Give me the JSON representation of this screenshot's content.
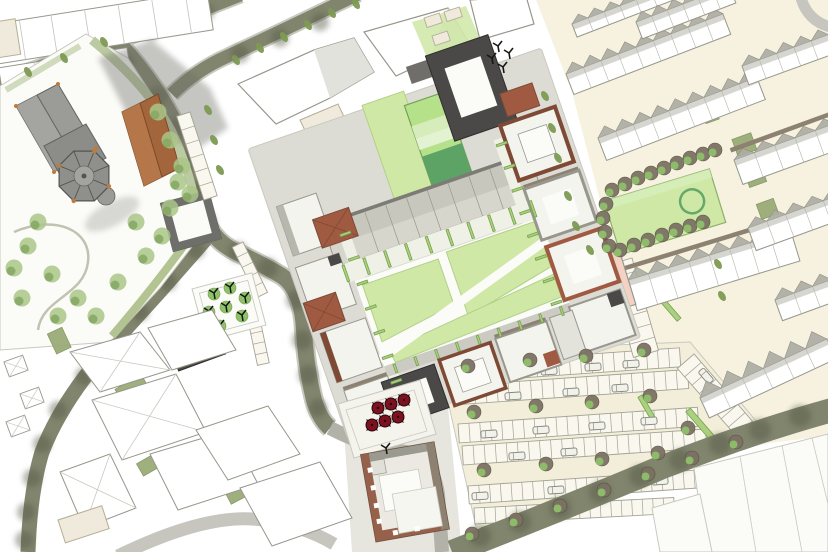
{
  "colors": {
    "bg": "#ffffff",
    "cream": "#f6f2df",
    "cream2": "#f3eeda",
    "cream_bldg": "#efeadb",
    "tan_stroke": "#b5ad96",
    "road_olive": "#82856e",
    "road_mid": "#b2b2a9",
    "road_gray": "#b7b7ae",
    "road_light": "#c6c6bf",
    "curb": "#c9c9c0",
    "road_shade": "#545743",
    "sidewalk": "#dcdcd4",
    "bldg_white": "#ffffff",
    "bldg_fill": "#f4f4ef",
    "white_soft": "#fbfbf8",
    "facet": "#e2e2dc",
    "bldg_stroke": "#97978d",
    "gray_soft": "#e6e6de",
    "gray_soft2": "#e3e3db",
    "roof_row": "#c7c7be",
    "roof_row_light": "#d8d8d0",
    "roof_gray": "#adada3",
    "roof_dark": "#7c7c74",
    "taupe": "#8d8172",
    "charcoal": "#4a4947",
    "charcoal_mid": "#6f6e6a",
    "charcoal_dark": "#2f2e2d",
    "terracotta": "#a05a42",
    "terracotta_dark": "#7e4a36",
    "copper": "#c07a3a",
    "church_gray": "#9b9b97",
    "church_gray2": "#8c8c88",
    "church_stroke": "#64645f",
    "roofring": "#6e6e6a",
    "brown_roof": "#a2653c",
    "brown_roof_light": "#b5764a",
    "shadow": "#6e6e68",
    "lawn": "#cfe8a6",
    "lawn_stroke": "#b2d188",
    "lawn_stroke2": "#8fae6b",
    "lawn_bright": "#b6e18b",
    "lawn_band": "#d6edbb",
    "lawn_band2": "#e3f2d0",
    "green_dark": "#5ea366",
    "green_ring": "#66a86a",
    "hedge_fill": "#abd07f",
    "hedge_stroke": "#75a24c",
    "garden_base": "#f0f1e6",
    "garden_olive": "#95a871",
    "tree_olive": "#7d9a52",
    "tree_soft": "#a9c687",
    "tree_soft_dark": "#86a861",
    "tree_brown": "#7b7164",
    "tree_green": "#8fc06a",
    "pink": "#f3d2c3",
    "umbrella_red": "#7c1120",
    "stall_fill": "#faf8ee",
    "stall_stroke": "#a3a396",
    "car_fill": "#f2f2ec"
  },
  "scene": {
    "street_trees": [
      [
        236,
        60
      ],
      [
        260,
        48
      ],
      [
        284,
        37
      ],
      [
        308,
        25
      ],
      [
        332,
        13
      ],
      [
        356,
        4
      ],
      [
        545,
        96
      ],
      [
        552,
        128
      ],
      [
        558,
        158
      ],
      [
        568,
        196
      ],
      [
        576,
        226
      ],
      [
        590,
        250
      ],
      [
        718,
        264
      ],
      [
        722,
        296
      ],
      [
        64,
        58
      ],
      [
        104,
        42
      ],
      [
        28,
        72
      ],
      [
        208,
        110
      ],
      [
        214,
        140
      ],
      [
        220,
        170
      ]
    ],
    "churchyard_trees": [
      [
        28,
        246
      ],
      [
        52,
        274
      ],
      [
        22,
        298
      ],
      [
        78,
        298
      ],
      [
        118,
        282
      ],
      [
        146,
        256
      ],
      [
        38,
        222
      ],
      [
        136,
        222
      ],
      [
        162,
        236
      ],
      [
        96,
        316
      ],
      [
        58,
        316
      ],
      [
        14,
        268
      ],
      [
        170,
        208
      ],
      [
        178,
        182
      ],
      [
        158,
        112
      ],
      [
        170,
        140
      ],
      [
        182,
        166
      ],
      [
        190,
        194
      ]
    ],
    "park_trees": [
      [
        612,
        190
      ],
      [
        625,
        184
      ],
      [
        638,
        178
      ],
      [
        651,
        173
      ],
      [
        664,
        168
      ],
      [
        677,
        163
      ],
      [
        690,
        158
      ],
      [
        703,
        154
      ],
      [
        715,
        150
      ],
      [
        620,
        250
      ],
      [
        634,
        245
      ],
      [
        648,
        240
      ],
      [
        662,
        235
      ],
      [
        676,
        230
      ],
      [
        690,
        226
      ],
      [
        703,
        222
      ],
      [
        606,
        204
      ],
      [
        603,
        218
      ],
      [
        605,
        232
      ],
      [
        609,
        246
      ]
    ],
    "lot_trees": [
      [
        468,
        366
      ],
      [
        530,
        360
      ],
      [
        586,
        356
      ],
      [
        644,
        350
      ],
      [
        474,
        412
      ],
      [
        536,
        406
      ],
      [
        592,
        402
      ],
      [
        650,
        396
      ],
      [
        484,
        470
      ],
      [
        546,
        464
      ],
      [
        602,
        459
      ],
      [
        658,
        453
      ],
      [
        688,
        428
      ],
      [
        472,
        534
      ],
      [
        516,
        520
      ],
      [
        560,
        506
      ],
      [
        604,
        490
      ],
      [
        648,
        474
      ],
      [
        692,
        458
      ],
      [
        736,
        442
      ]
    ],
    "pocket_trees": [
      [
        214,
        294
      ],
      [
        230,
        288
      ],
      [
        245,
        298
      ],
      [
        209,
        312
      ],
      [
        226,
        307
      ],
      [
        242,
        316
      ],
      [
        220,
        326
      ],
      [
        370,
        446
      ]
    ],
    "black_marks": [
      [
        498,
        46
      ],
      [
        492,
        58
      ],
      [
        503,
        67
      ],
      [
        509,
        53
      ],
      [
        386,
        448
      ]
    ],
    "umbrellas": [
      [
        378,
        408
      ],
      [
        391,
        404
      ],
      [
        404,
        400
      ],
      [
        372,
        425
      ],
      [
        385,
        421
      ],
      [
        398,
        417
      ]
    ],
    "road_shadows": [
      [
        150,
        30,
        10
      ],
      [
        100,
        48,
        9
      ],
      [
        50,
        68,
        10
      ],
      [
        205,
        12,
        9
      ],
      [
        240,
        54,
        9
      ],
      [
        280,
        38,
        9
      ],
      [
        320,
        22,
        9
      ],
      [
        125,
        62,
        9
      ],
      [
        158,
        96,
        10
      ],
      [
        176,
        128,
        10
      ],
      [
        188,
        160,
        10
      ],
      [
        196,
        192,
        10
      ],
      [
        206,
        222,
        10
      ],
      [
        238,
        252,
        10
      ],
      [
        268,
        268,
        10
      ],
      [
        296,
        300,
        10
      ],
      [
        302,
        340,
        10
      ],
      [
        308,
        375,
        10
      ],
      [
        318,
        408,
        9
      ],
      [
        480,
        536,
        11
      ],
      [
        520,
        522,
        11
      ],
      [
        560,
        508,
        11
      ],
      [
        600,
        492,
        11
      ],
      [
        640,
        476,
        11
      ],
      [
        680,
        460,
        11
      ],
      [
        720,
        444,
        11
      ],
      [
        760,
        430,
        11
      ],
      [
        800,
        416,
        11
      ],
      [
        196,
        250,
        9
      ],
      [
        168,
        282,
        9
      ],
      [
        140,
        312,
        9
      ],
      [
        112,
        344,
        9
      ],
      [
        84,
        376,
        9
      ],
      [
        58,
        410,
        9
      ],
      [
        42,
        444,
        9
      ],
      [
        32,
        478,
        9
      ],
      [
        26,
        512,
        9
      ],
      [
        24,
        540,
        9
      ]
    ],
    "stall_rows": [
      [
        448,
        364,
        -4,
        232,
        19,
        21
      ],
      [
        452,
        386,
        -4,
        236,
        19,
        21
      ],
      [
        458,
        424,
        -4,
        240,
        19,
        22
      ],
      [
        462,
        446,
        -4,
        244,
        19,
        22
      ],
      [
        468,
        486,
        -4,
        248,
        18,
        23
      ],
      [
        474,
        508,
        -3,
        200,
        16,
        19
      ],
      [
        694,
        354,
        49,
        100,
        22,
        9
      ],
      [
        632,
        258,
        74,
        96,
        26,
        7
      ]
    ],
    "stall_rows_minor": [
      [
        190,
        112,
        72,
        88,
        14,
        6
      ],
      [
        243,
        242,
        64,
        56,
        12,
        5
      ],
      [
        258,
        310,
        78,
        54,
        12,
        5
      ]
    ],
    "cars": [
      [
        505,
        374,
        -4
      ],
      [
        549,
        371,
        -4
      ],
      [
        593,
        367,
        -4
      ],
      [
        631,
        364,
        -4
      ],
      [
        513,
        396,
        -4
      ],
      [
        571,
        392,
        -4
      ],
      [
        620,
        388,
        -4
      ],
      [
        489,
        434,
        -4
      ],
      [
        541,
        430,
        -4
      ],
      [
        597,
        426,
        -4
      ],
      [
        649,
        421,
        -4
      ],
      [
        517,
        456,
        -4
      ],
      [
        569,
        452,
        -4
      ],
      [
        480,
        496,
        -4
      ],
      [
        556,
        490,
        -4
      ],
      [
        612,
        486,
        -4
      ],
      [
        660,
        481,
        -4
      ],
      [
        706,
        376,
        49
      ],
      [
        718,
        396,
        49
      ]
    ],
    "hedges": [
      [
        441,
        356,
        -3,
        40,
        5
      ],
      [
        482,
        530,
        -19,
        124,
        5
      ],
      [
        604,
        486,
        -21,
        118,
        5
      ],
      [
        640,
        396,
        60,
        30,
        5
      ],
      [
        688,
        410,
        49,
        44,
        6
      ],
      [
        662,
        300,
        49,
        26,
        5
      ],
      [
        712,
        502,
        -20,
        10,
        9
      ],
      [
        746,
        478,
        -20,
        10,
        9
      ],
      [
        782,
        456,
        -20,
        10,
        9
      ],
      [
        724,
        540,
        -20,
        10,
        9
      ]
    ],
    "dev_hedges": [
      [
        344,
        229,
        90,
        17,
        2.4
      ],
      [
        366,
        229,
        90,
        17,
        2.4
      ],
      [
        388,
        229,
        90,
        17,
        2.4
      ],
      [
        410,
        229,
        90,
        17,
        2.4
      ],
      [
        432,
        229,
        90,
        17,
        2.4
      ],
      [
        454,
        229,
        90,
        17,
        2.4
      ],
      [
        476,
        229,
        90,
        17,
        2.4
      ],
      [
        498,
        229,
        90,
        17,
        2.4
      ],
      [
        520,
        229,
        90,
        17,
        2.4
      ],
      [
        542,
        229,
        90,
        17,
        2.4
      ],
      [
        360,
        339,
        90,
        9,
        2.2
      ],
      [
        382,
        339,
        90,
        9,
        2.2
      ],
      [
        404,
        339,
        90,
        9,
        2.2
      ],
      [
        426,
        339,
        90,
        9,
        2.2
      ],
      [
        448,
        339,
        90,
        9,
        2.2
      ],
      [
        470,
        339,
        90,
        9,
        2.2
      ],
      [
        492,
        339,
        90,
        9,
        2.2
      ],
      [
        514,
        339,
        90,
        9,
        2.2
      ],
      [
        536,
        339,
        90,
        9,
        2.2
      ],
      [
        351,
        200,
        0,
        11,
        2.4
      ],
      [
        351,
        226,
        0,
        11,
        2.4
      ],
      [
        351,
        252,
        0,
        11,
        2.4
      ],
      [
        351,
        278,
        0,
        11,
        2.4
      ],
      [
        351,
        304,
        0,
        11,
        2.4
      ],
      [
        351,
        330,
        0,
        11,
        2.4
      ],
      [
        351,
        356,
        0,
        11,
        2.4
      ],
      [
        528,
        166,
        0,
        11,
        2.4
      ],
      [
        528,
        190,
        0,
        11,
        2.4
      ],
      [
        528,
        214,
        0,
        11,
        2.4
      ],
      [
        528,
        238,
        0,
        11,
        2.4
      ],
      [
        528,
        262,
        0,
        11,
        2.4
      ],
      [
        528,
        286,
        0,
        11,
        2.4
      ],
      [
        528,
        310,
        0,
        11,
        2.4
      ],
      [
        528,
        334,
        0,
        11,
        2.4
      ]
    ],
    "garden_patches": [
      [
        735,
        148,
        -20,
        20,
        18
      ],
      [
        747,
        180,
        -20,
        18,
        16
      ],
      [
        759,
        212,
        -20,
        18,
        16
      ],
      [
        704,
        118,
        -20,
        14,
        12
      ],
      [
        772,
        244,
        -20,
        16,
        14
      ],
      [
        120,
        398,
        -30,
        30,
        20
      ],
      [
        163,
        434,
        -32,
        28,
        18
      ],
      [
        205,
        468,
        -30,
        26,
        16
      ],
      [
        90,
        362,
        -32,
        22,
        14
      ],
      [
        228,
        498,
        -28,
        24,
        14
      ],
      [
        52,
        344,
        -25,
        16,
        22
      ],
      [
        140,
        470,
        -30,
        18,
        14
      ]
    ],
    "terrace_rows": [
      [
        566,
        74,
        -21,
        168,
        9,
        22,
        9,
        0
      ],
      [
        598,
        138,
        -21,
        170,
        9,
        24,
        9,
        0
      ],
      [
        572,
        24,
        -21,
        120,
        7,
        14,
        7,
        0
      ],
      [
        628,
        280,
        -17,
        170,
        10,
        32,
        8,
        1
      ],
      [
        700,
        398,
        -25,
        140,
        13,
        22,
        6,
        0
      ],
      [
        734,
        160,
        -20,
        108,
        8,
        26,
        5,
        1
      ],
      [
        748,
        228,
        -20,
        100,
        8,
        24,
        5,
        0
      ],
      [
        742,
        66,
        -20,
        92,
        8,
        20,
        5,
        0
      ],
      [
        636,
        22,
        -21,
        100,
        8,
        18,
        6,
        0
      ],
      [
        775,
        300,
        -20,
        80,
        9,
        22,
        4,
        0
      ]
    ]
  }
}
